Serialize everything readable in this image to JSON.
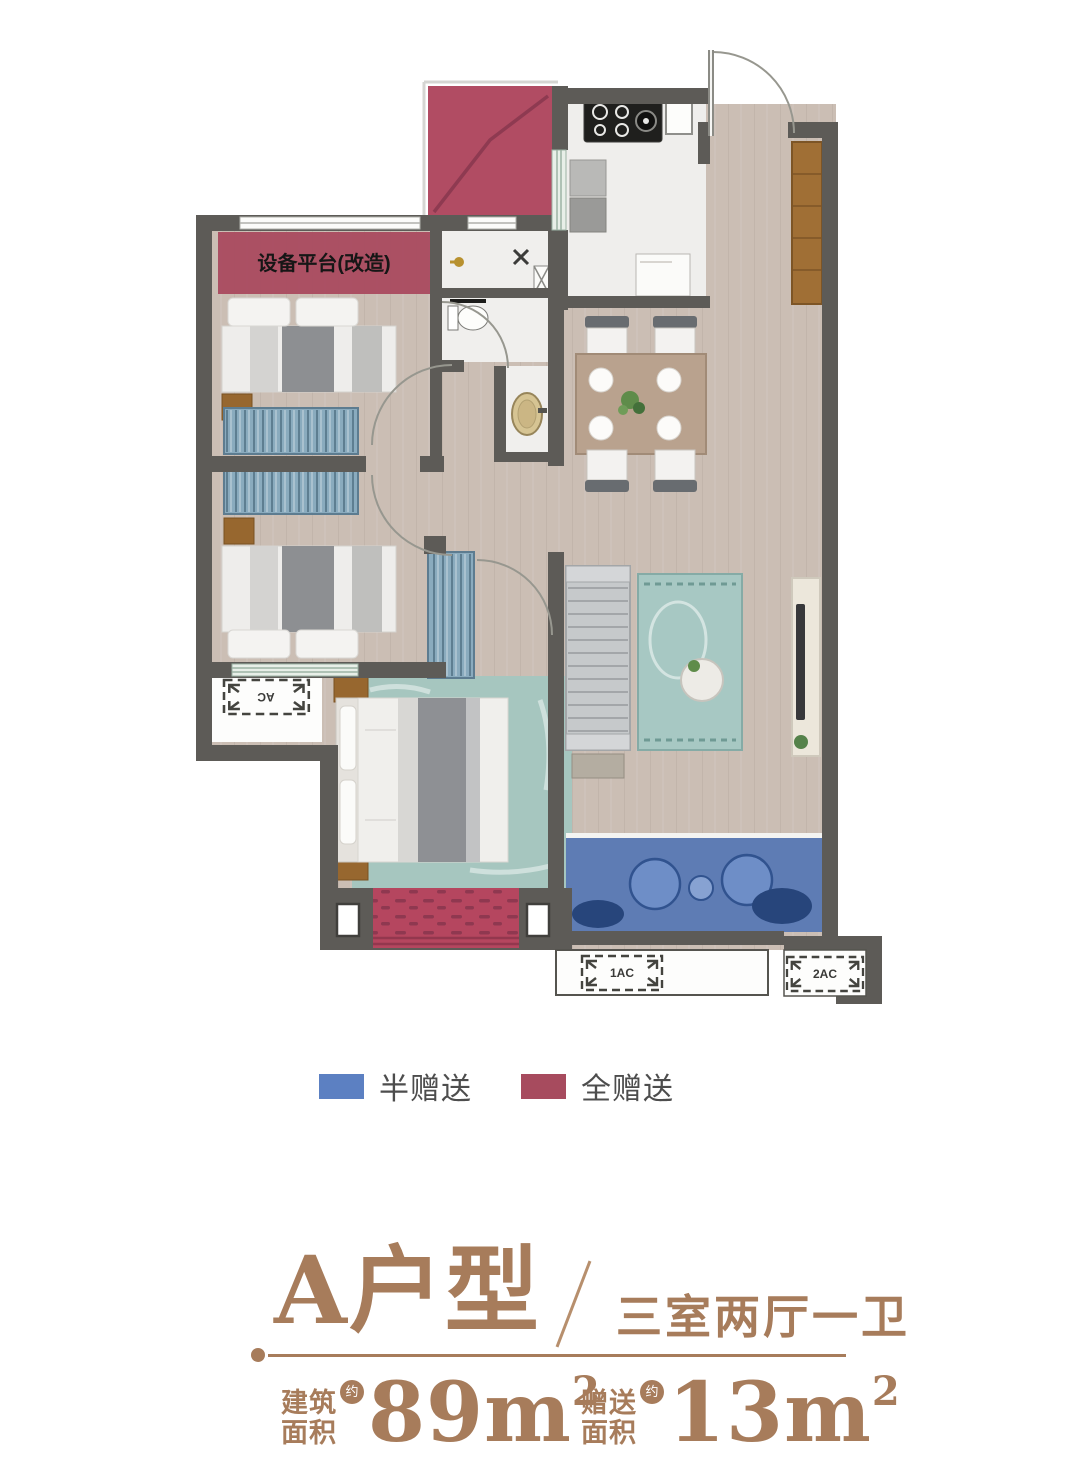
{
  "floor_plan": {
    "labels": {
      "equipment_platform": "设备平台(改造)",
      "ac_side": "AC",
      "ac_1": "1AC",
      "ac_2": "2AC"
    },
    "colors": {
      "wall": "#5d5b57",
      "wood_floor": "#cbbeb4",
      "marble_floor": "#efeeec",
      "half_gift_blue": "#4f73b4",
      "full_gift_red": "#b14c63",
      "carpet_red": "#b5465f",
      "rug_teal": "#a7c8c3"
    }
  },
  "legend": {
    "items": [
      {
        "label": "半赠送",
        "color": "#5c80c2"
      },
      {
        "label": "全赠送",
        "color": "#a74b5e"
      }
    ]
  },
  "title": {
    "unit_name": "A户型",
    "layout": "三室两厅一卫"
  },
  "stats": {
    "items": [
      {
        "label_top": "建筑",
        "label_bottom": "面积",
        "approx": "约",
        "value": "89m",
        "exponent": "2"
      },
      {
        "label_top": "赠送",
        "label_bottom": "面积",
        "approx": "约",
        "value": "13m",
        "exponent": "2"
      }
    ]
  },
  "accent_color": "#a77c5b"
}
